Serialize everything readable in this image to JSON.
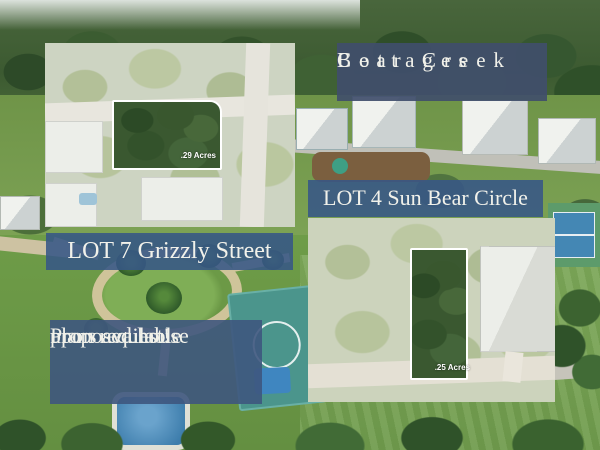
{
  "title": {
    "line1": "Bear Creek",
    "line2": "Cottages"
  },
  "lot4": {
    "label": "LOT 4 Sun Bear Circle",
    "acreage": ".25 Acres"
  },
  "lot7": {
    "label": "LOT 7 Grizzly Street",
    "acreage": ".29 Acres"
  },
  "note": {
    "line1": "Proposed house",
    "line2": "plans available",
    "line3": "upon request!"
  },
  "colors": {
    "title_banner_bg": "#404e6b",
    "street_label_bg": "#375686",
    "banner_text": "#f1f1ea",
    "lot_highlight_border": "#ffffff"
  }
}
